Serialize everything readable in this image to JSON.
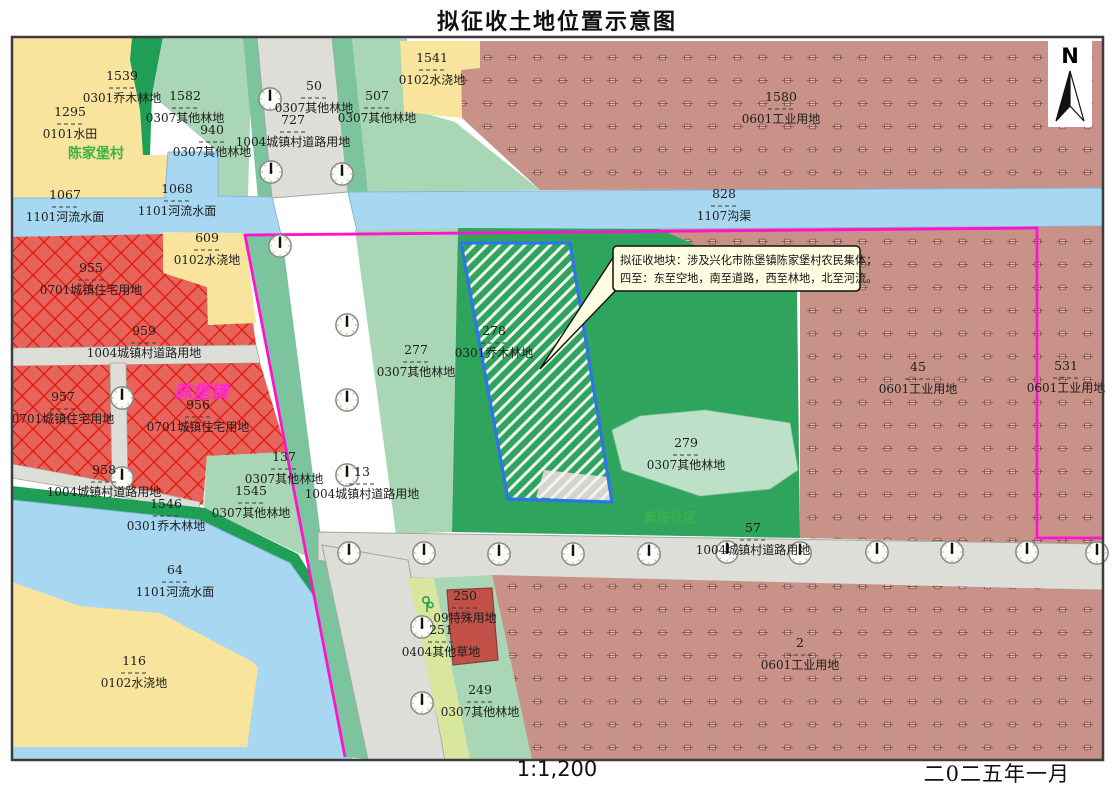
{
  "title": "拟征收土地位置示意图",
  "footer": {
    "scale": "1:1,200",
    "date": "二0二五年一月"
  },
  "north_arrow": {
    "label": "N"
  },
  "callout": {
    "line1": "拟征收地块：涉及兴化市陈堡镇陈家堡村农民集体；",
    "line2": "四至：东至空地，南至道路，西至林地，北至河流。"
  },
  "place_names": [
    {
      "name": "陈家堡村",
      "x": 96,
      "y": 158,
      "color": "#3db24a",
      "size": 14,
      "italic": false
    },
    {
      "name": "陈堡镇",
      "x": 201,
      "y": 398,
      "color": "#ff26d6",
      "size": 18,
      "italic": true
    },
    {
      "name": "新陈社区",
      "x": 670,
      "y": 522,
      "color": "#3db24a",
      "size": 13,
      "italic": false
    }
  ],
  "parcels": [
    {
      "number": "1539",
      "type": "0301乔木林地",
      "x": 122,
      "y": 80
    },
    {
      "number": "1295",
      "type": "0101水田",
      "x": 70,
      "y": 116
    },
    {
      "number": "1582",
      "type": "0307其他林地",
      "x": 185,
      "y": 100
    },
    {
      "number": "940",
      "type": "0307其他林地",
      "x": 212,
      "y": 134
    },
    {
      "number": "50",
      "type": "0307其他林地",
      "x": 314,
      "y": 90
    },
    {
      "number": "727",
      "type": "1004城镇村道路用地",
      "x": 293,
      "y": 124
    },
    {
      "number": "507",
      "type": "0307其他林地",
      "x": 377,
      "y": 100
    },
    {
      "number": "1541",
      "type": "0102水浇地",
      "x": 432,
      "y": 62
    },
    {
      "number": "1580",
      "type": "0601工业用地",
      "x": 781,
      "y": 101
    },
    {
      "number": "828",
      "type": "1107沟渠",
      "x": 724,
      "y": 198
    },
    {
      "number": "1067",
      "type": "1101河流水面",
      "x": 65,
      "y": 199
    },
    {
      "number": "1068",
      "type": "1101河流水面",
      "x": 177,
      "y": 193
    },
    {
      "number": "609",
      "type": "0102水浇地",
      "x": 207,
      "y": 242
    },
    {
      "number": "955",
      "type": "0701城镇住宅用地",
      "x": 91,
      "y": 272
    },
    {
      "number": "959",
      "type": "1004城镇村道路用地",
      "x": 144,
      "y": 335
    },
    {
      "number": "957",
      "type": "0701城镇住宅用地",
      "x": 63,
      "y": 401
    },
    {
      "number": "956",
      "type": "0701城镇住宅用地",
      "x": 198,
      "y": 409
    },
    {
      "number": "958",
      "type": "1004城镇村道路用地",
      "x": 104,
      "y": 474
    },
    {
      "number": "1546",
      "type": "0301乔木林地",
      "x": 166,
      "y": 508
    },
    {
      "number": "137",
      "type": "0307其他林地",
      "x": 284,
      "y": 461
    },
    {
      "number": "1545",
      "type": "0307其他林地",
      "x": 251,
      "y": 495
    },
    {
      "number": "64",
      "type": "1101河流水面",
      "x": 175,
      "y": 574
    },
    {
      "number": "116",
      "type": "0102水浇地",
      "x": 134,
      "y": 665
    },
    {
      "number": "277",
      "type": "0307其他林地",
      "x": 416,
      "y": 354
    },
    {
      "number": "13",
      "type": "1004城镇村道路用地",
      "x": 362,
      "y": 476
    },
    {
      "number": "278",
      "type": "0301乔木林地",
      "x": 494,
      "y": 335
    },
    {
      "number": "279",
      "type": "0307其他林地",
      "x": 686,
      "y": 447
    },
    {
      "number": "45",
      "type": "0601工业用地",
      "x": 918,
      "y": 371
    },
    {
      "number": "531",
      "type": "0601工业用地",
      "x": 1066,
      "y": 370
    },
    {
      "number": "57",
      "type": "1004城镇村道路用地",
      "x": 753,
      "y": 532
    },
    {
      "number": "2",
      "type": "0601工业用地",
      "x": 800,
      "y": 647
    },
    {
      "number": "250",
      "type": "09特殊用地",
      "x": 465,
      "y": 600
    },
    {
      "number": "251",
      "type": "0404其他草地",
      "x": 441,
      "y": 634
    },
    {
      "number": "249",
      "type": "0307其他林地",
      "x": 480,
      "y": 694
    }
  ],
  "street_lights": [
    [
      270,
      99
    ],
    [
      271,
      172
    ],
    [
      342,
      174
    ],
    [
      280,
      246
    ],
    [
      347,
      325
    ],
    [
      347,
      400
    ],
    [
      347,
      475
    ],
    [
      349,
      553
    ],
    [
      424,
      553
    ],
    [
      499,
      554
    ],
    [
      573,
      554
    ],
    [
      649,
      554
    ],
    [
      727,
      552
    ],
    [
      800,
      553
    ],
    [
      877,
      552
    ],
    [
      952,
      552
    ],
    [
      1027,
      552
    ],
    [
      1097,
      553
    ],
    [
      422,
      627
    ],
    [
      422,
      703
    ],
    [
      122,
      398
    ],
    [
      122,
      478
    ]
  ],
  "tree_symbols": [
    [
      428,
      604
    ]
  ],
  "colors": {
    "paddy_yellow": "#f8e49c",
    "forest_dark_green": "#1f9e55",
    "forest_light_green": "#a9d6b5",
    "shoulder_green": "#7cc49e",
    "big_green": "#2fa45c",
    "parcel279_green": "#bce0c8",
    "grass_strip": "#d9e79e",
    "water_blue": "#a8d7f2",
    "road_gray": "#dedeD9",
    "residential_red": "#e7645c",
    "residential_line": "#e41b0f",
    "industrial_brown": "#c99289",
    "special_red": "#c05048",
    "boundary_magenta": "#ff14ce",
    "target_outline_blue": "#2e75e8",
    "callout_yellow": "#fffde1"
  }
}
